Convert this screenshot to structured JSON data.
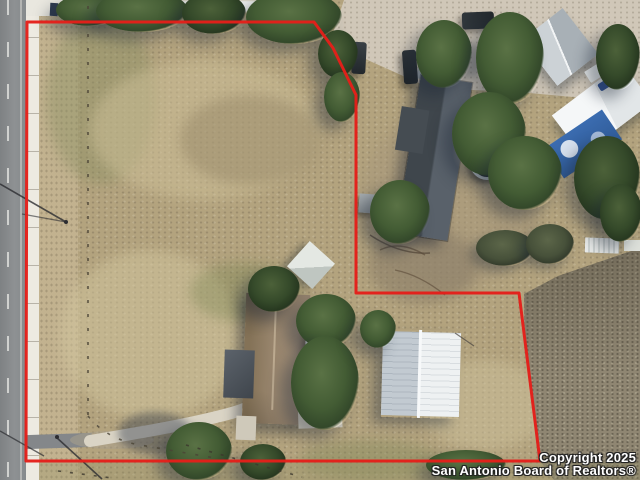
{
  "meta": {
    "type": "aerial-photograph",
    "description": "Drone aerial view of a rural residential lot outlined with a red property-boundary line; road on left, two houses, white workshop building, neighboring barns, dry tan field, scattered trees"
  },
  "watermark": {
    "line1": "Copyright 2025",
    "line2": "San Antonio Board of Realtors®"
  },
  "colors": {
    "boundary": "#e41f1a",
    "field": "#b3a37e",
    "road": "#87898b",
    "sidewalk": "#edeae1",
    "tree": "#43582f",
    "main_house_roof": "#495057",
    "guest_house_roof": "#97846c",
    "workshop_roof": "#e8ecee",
    "barn_roof": "#bcc2c7",
    "tarp_blue": "#3b6cb0",
    "scrub": "#8f8672"
  },
  "features": [
    {
      "name": "boundary-line",
      "detail": "red outlined parcel polygon"
    },
    {
      "name": "road",
      "detail": "two-lane asphalt road with dashed center line"
    },
    {
      "name": "sidewalk",
      "detail": "concrete strip along road"
    },
    {
      "name": "main-house",
      "detail": "dark gray roof house, upper right"
    },
    {
      "name": "guest-house",
      "detail": "brown shingle roof house with white metal awning"
    },
    {
      "name": "workshop-building",
      "detail": "white ribbed metal roof outbuilding inside boundary"
    },
    {
      "name": "metal-barn",
      "detail": "gray metal barn, top right"
    },
    {
      "name": "white-barn",
      "detail": "bright white roof building with blue tarp"
    },
    {
      "name": "trampoline",
      "detail": "dark round trampoline behind main house"
    },
    {
      "name": "vehicles",
      "detail": "three dark SUVs on gravel driveway"
    },
    {
      "name": "driveway",
      "detail": "curved concrete driveway from road to guest house"
    },
    {
      "name": "fence-line",
      "detail": "post fence along west field edge"
    },
    {
      "name": "trees",
      "detail": "scattered green tree canopies"
    },
    {
      "name": "scrub-field",
      "detail": "gray-brown brush field outside boundary, lower right"
    }
  ]
}
